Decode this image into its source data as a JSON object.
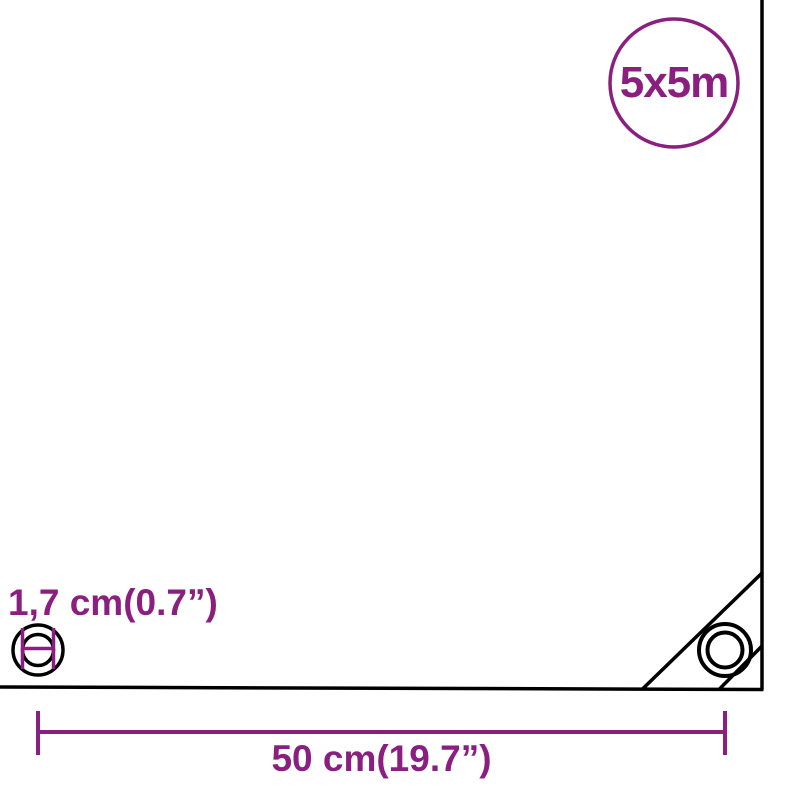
{
  "diagram": {
    "badge": {
      "label": "5x5m",
      "shape": "circle-outline"
    },
    "grommet": {
      "label": "1,7 cm(0.7”)",
      "icon": "grommet-diameter-icon"
    },
    "width_measure": {
      "label": "50 cm(19.7”)",
      "icon": "measure-line-icon"
    }
  },
  "colors": {
    "accent": "#8A1F80",
    "ink": "#000000",
    "background": "#FFFFFF"
  }
}
